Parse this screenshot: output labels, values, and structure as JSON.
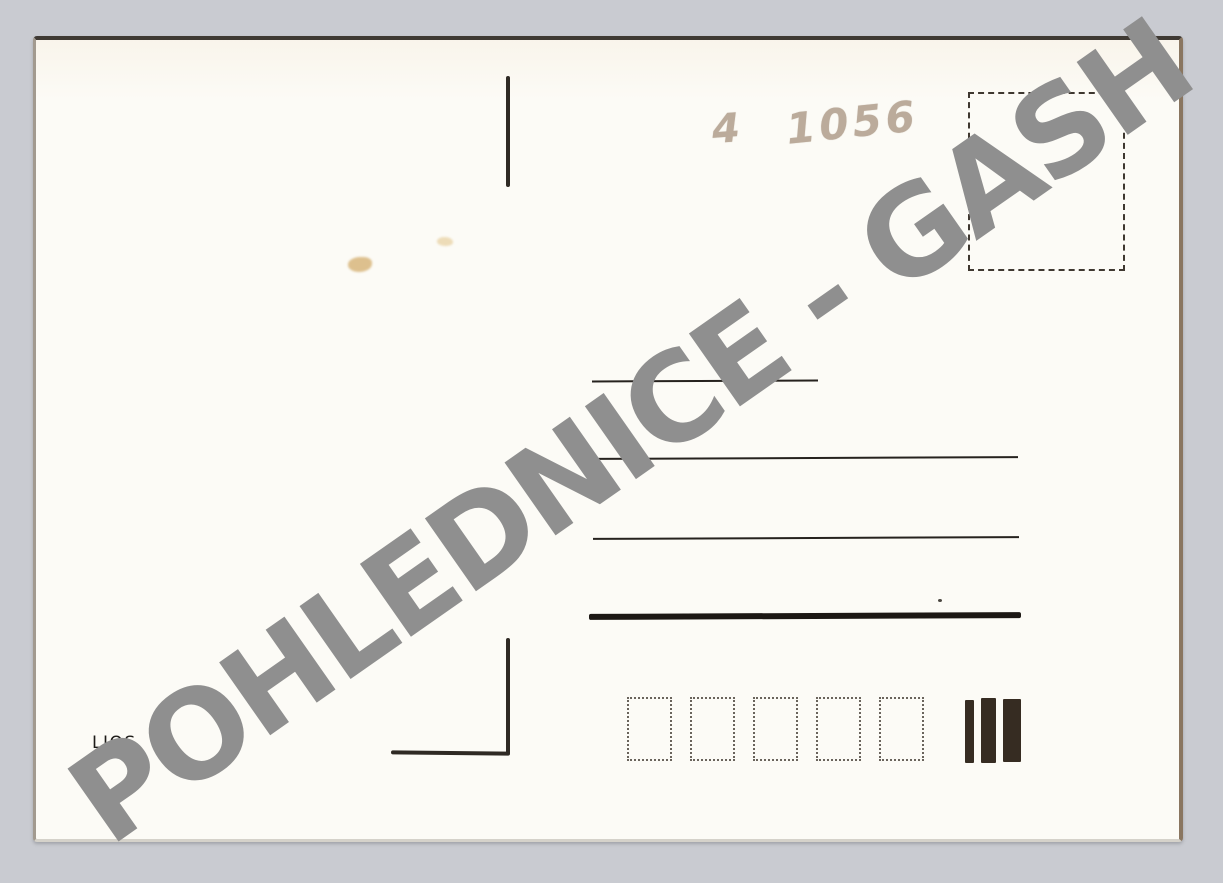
{
  "page": {
    "description": "Scanned back of a blank vintage postcard with reseller watermark",
    "background_color_hex": "#c9cbd1",
    "card_color_hex": "#fcfbf6"
  },
  "watermark": {
    "text": "POHLEDNICE - GASH",
    "color_hex": "#8f8f8f"
  },
  "handwritten_note": {
    "part1": "4",
    "part2": "1056",
    "pencil_color_hex": "#b4a392"
  },
  "publisher_mark": {
    "text": "LIOS"
  },
  "postcard_features": {
    "stamp_box": "empty dashed-outline square for postage stamp",
    "address_line_count": 4,
    "postal_code_box_count": 5,
    "sorting_bar_count": 3,
    "line_color_hex": "#26221e"
  }
}
